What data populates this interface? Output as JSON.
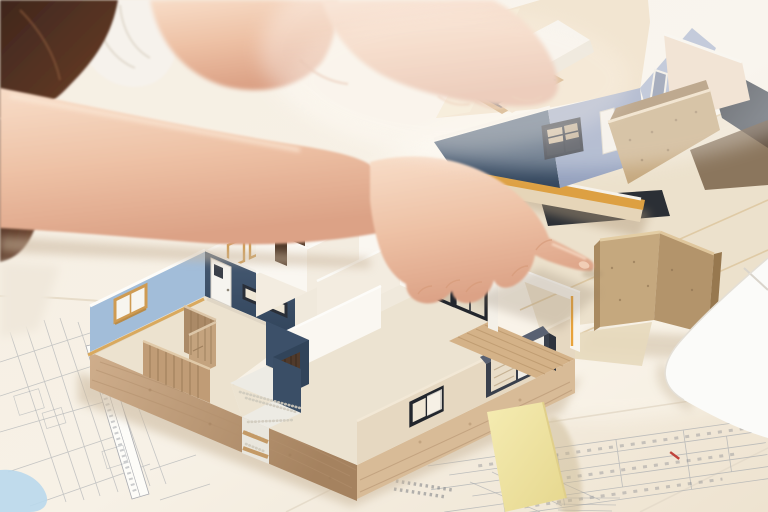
{
  "scene": {
    "type": "photograph",
    "description": "Two people at a bright white worktable reviewing architectural scale models: a woman's hand points with an index finger at the terrace frame of an open-top single-story house model with blue and white walls on a wooden base; a second finished house model with a cream roof, dark skylight and plywood balcony rests on stacked boards behind it; construction blueprints, a blank yellow sticky note, a plywood wall piece and the corner of a white laptop lie on the table."
  },
  "objects": {
    "person": {
      "label": "two people leaning over the table",
      "pointing_hand": "index finger touching the model terrace frame"
    },
    "main_model": {
      "label": "open-top floor-plan house model",
      "features": [
        "light-blue exterior wall with window",
        "navy wall with white door and slit window",
        "white room partitions",
        "pebble-floor entry porch with dark door",
        "wood partition wall",
        "black-framed windows and bay window",
        "white terrace frame with wood deck",
        "wood base platform"
      ]
    },
    "second_model": {
      "label": "finished house model on stacked baseboards",
      "features": [
        "cream flat roof",
        "dark L-shaped skylight",
        "white roof parapet",
        "slate and navy walls",
        "plywood balcony"
      ]
    },
    "sticky_note": {
      "label": "blank yellow sticky note"
    },
    "blueprints": {
      "label": "construction drawing sheets with dimension lines"
    },
    "laptop": {
      "label": "white laptop corner"
    },
    "plywood_piece": {
      "label": "plywood wall corner piece"
    }
  },
  "colors": {
    "table_base": "#f2e9da",
    "table_bright": "#fbf6ec",
    "hair_dark": "#3f261d",
    "hair_light": "#6e4129",
    "skin_light": "#f8ddc8",
    "skin_mid": "#eec2a6",
    "skin_deep": "#dca286",
    "shirt_white": "#f6f2ec",
    "blueprint_line": "#989ba2",
    "blueprint_red": "#c0443c",
    "paper_blue": "#b9d8ec",
    "sticky_yellow": "#f1e7a6",
    "sticky_edge": "#e0cf8a",
    "laptop_white": "#fbfbf9",
    "wall_light_blue": "#a2bdd9",
    "wall_navy": "#3c5069",
    "wall_white": "#faf7f1",
    "wall_shadow": "#f0e8da",
    "floor_cream": "#ece2cf",
    "ext_wall_cream": "#e6d8c1",
    "wood_base": "#cfae8c",
    "wood_dark": "#a5825f",
    "frame_tan": "#cf9b52",
    "frame_orange": "#e8a33c",
    "window_black": "#22262d",
    "pebble_white": "#edebe4",
    "deck_wood": "#d4b288",
    "partition_wood": "#ab8a67",
    "fence_wood": "#c09c76",
    "m2_roof": "#ecd9bb",
    "m2_slate": "#93a0bd",
    "m2_slate_light": "#a9b3ca",
    "m2_navy": "#46536f",
    "m2_skylight": "#171b22",
    "m2_skylight_frame": "#c08d4b",
    "m2_ply": "#c5a87e",
    "m2_ply_dark": "#a0805a",
    "m2_orange": "#dda042",
    "board_dark": "#2b2f35",
    "board_cream": "#ece1cc",
    "balcony_back": "#ecd8c2"
  }
}
